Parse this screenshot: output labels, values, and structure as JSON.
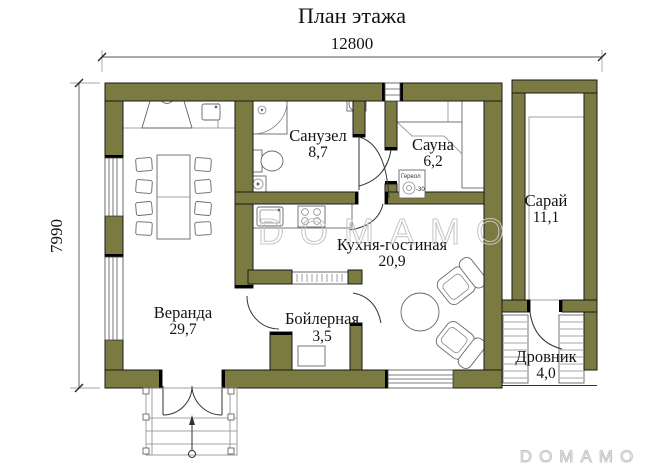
{
  "title": "План этажа",
  "dimensions": {
    "width_mm": "12800",
    "height_mm": "7990"
  },
  "rooms": {
    "sanuzel": {
      "name": "Санузел",
      "area": "8,7"
    },
    "sauna": {
      "name": "Сауна",
      "area": "6,2"
    },
    "saray": {
      "name": "Сарай",
      "area": "11,1"
    },
    "kitchen": {
      "name": "Кухня-гостиная",
      "area": "20,9"
    },
    "veranda": {
      "name": "Веранда",
      "area": "29,7"
    },
    "boiler": {
      "name": "Бойлерная",
      "area": "3,5"
    },
    "drovnik": {
      "name": "Дровник",
      "area": "4,0"
    }
  },
  "equipment": {
    "sauna_heater_label": "Гереол",
    "sauna_heater_power": "-30"
  },
  "watermark": {
    "center": "DOMAMO",
    "bottom": "DOMAMO"
  },
  "colors": {
    "wall": "#7b7a41",
    "outline": "#1a1a1a",
    "dim": "#555555",
    "text": "#141414",
    "wm": "#c4c4c4",
    "bg": "#ffffff"
  }
}
